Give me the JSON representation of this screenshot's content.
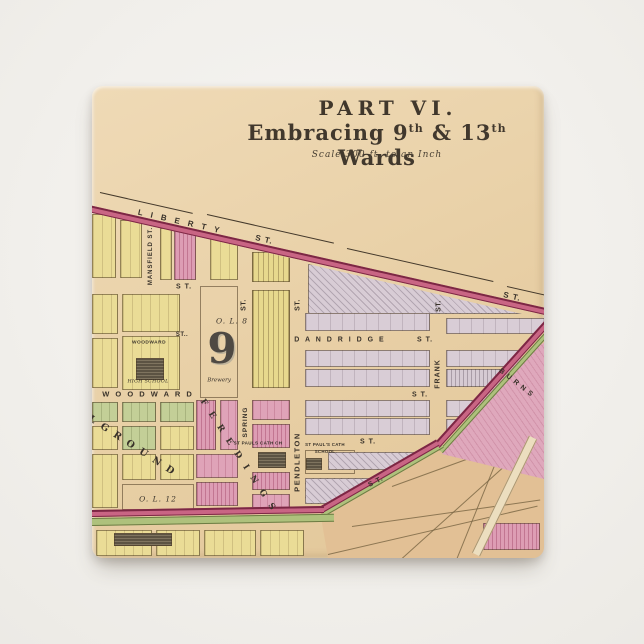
{
  "page": {
    "background_color": "#f1efeb"
  },
  "button": {
    "surface_color": "#e9d1a8",
    "shape": "square-pin"
  },
  "map": {
    "title": "PART VI.",
    "subtitle_parts": {
      "a": "Embracing 9",
      "b": "th",
      "c": " & 13",
      "d": "th",
      "e": " Wards"
    },
    "scale_note": "Scale 300 ft. to an Inch",
    "ward_number": "9",
    "colors": {
      "paper": "#e9d1a8",
      "road_pink": "#c96584",
      "road_border": "#7c2744",
      "green_strip": "#aec17c",
      "block_yellow": "#eadc96",
      "block_lavender": "#d9cdd6",
      "block_pink": "#dfa3b8",
      "block_green": "#c3cf97",
      "area_tan": "#e2c095",
      "ink": "#39322a"
    },
    "labels": [
      {
        "n": "street-label-liberty",
        "t": "L I B E R T Y",
        "x": 88,
        "y": 136,
        "s": 8,
        "r": 12.7,
        "ls": 3,
        "c": "lb-st"
      },
      {
        "n": "street-label-liberty-st",
        "t": "S T.",
        "x": 172,
        "y": 154,
        "s": 8,
        "r": 12.7,
        "ls": 1,
        "c": "lb-st"
      },
      {
        "n": "street-label-liberty-st-2",
        "t": "S T.",
        "x": 420,
        "y": 211,
        "s": 8,
        "r": 12.7,
        "ls": 1,
        "c": "lb-st"
      },
      {
        "n": "street-label-mansfield",
        "t": "MANSFIELD ST.",
        "x": 59,
        "y": 170,
        "s": 6,
        "r": -90,
        "ls": 1,
        "c": "lb-st"
      },
      {
        "n": "street-label-st-left",
        "t": "S T.",
        "x": 92,
        "y": 201,
        "s": 7,
        "r": 0,
        "ls": 1,
        "c": "lb-st"
      },
      {
        "n": "street-label-st-small",
        "t": "ST..",
        "x": 90,
        "y": 249,
        "s": 6,
        "r": 0,
        "ls": 0.5,
        "c": "lb-st"
      },
      {
        "n": "street-label-st-v1",
        "t": "ST.",
        "x": 152,
        "y": 219,
        "s": 7,
        "r": -90,
        "ls": 0.5,
        "c": "lb-st"
      },
      {
        "n": "street-label-st-v2",
        "t": "ST.",
        "x": 206,
        "y": 219,
        "s": 7,
        "r": -90,
        "ls": 0.5,
        "c": "lb-st"
      },
      {
        "n": "outlot-label-8",
        "t": "O. L.  8",
        "x": 140,
        "y": 235,
        "s": 7.5,
        "r": 0,
        "ls": 1,
        "c": "lb-it"
      },
      {
        "n": "ward-number",
        "t": "9",
        "x": 130,
        "y": 263,
        "s": 42,
        "r": 0,
        "ls": 0,
        "c": "lb-ward"
      },
      {
        "n": "place-label-brewery",
        "t": "Brewery",
        "x": 127,
        "y": 295,
        "s": 5.5,
        "r": 0,
        "ls": 0,
        "c": "lb-it"
      },
      {
        "n": "place-label-woodward-school-1",
        "t": "WOODWARD",
        "x": 57,
        "y": 258,
        "s": 4.8,
        "r": 0,
        "ls": 0.5,
        "c": "lb-st"
      },
      {
        "n": "place-label-woodward-school-2",
        "t": "HIGH SCHOOL",
        "x": 56,
        "y": 297,
        "s": 4.8,
        "r": 0,
        "ls": 0.3,
        "c": "lb-it"
      },
      {
        "n": "street-label-woodward",
        "t": "W O O D W A R D",
        "x": 56,
        "y": 308,
        "s": 7.5,
        "r": 0,
        "ls": 2,
        "c": "lb-st"
      },
      {
        "n": "street-label-dandridge",
        "t": "D A N D R I D G E",
        "x": 248,
        "y": 254,
        "s": 7,
        "r": 0,
        "ls": 2,
        "c": "lb-st"
      },
      {
        "n": "street-label-dandridge-st",
        "t": "S T.",
        "x": 333,
        "y": 254,
        "s": 7,
        "r": 0,
        "ls": 1,
        "c": "lb-st"
      },
      {
        "n": "street-label-frank-st-part",
        "t": "ST.",
        "x": 347,
        "y": 220,
        "s": 7,
        "r": -90,
        "ls": 0.5,
        "c": "lb-st"
      },
      {
        "n": "street-label-frank",
        "t": "FRANK",
        "x": 346,
        "y": 288,
        "s": 7,
        "r": -90,
        "ls": 1,
        "c": "lb-st"
      },
      {
        "n": "street-label-st-right",
        "t": "S T.",
        "x": 328,
        "y": 309,
        "s": 7,
        "r": 0,
        "ls": 1,
        "c": "lb-st"
      },
      {
        "n": "street-label-spring",
        "t": "SPRING",
        "x": 154,
        "y": 336,
        "s": 6.5,
        "r": -90,
        "ls": 1,
        "c": "lb-st"
      },
      {
        "n": "street-label-pendleton",
        "t": "PENDLETON",
        "x": 205,
        "y": 376,
        "s": 7.5,
        "r": -90,
        "ls": 1.5,
        "c": "lb-st"
      },
      {
        "n": "place-label-st-pauls-church",
        "t": "ST PAULS CATH CH",
        "x": 166,
        "y": 358,
        "s": 4.6,
        "r": 0,
        "ls": 0.3,
        "c": "lb-st"
      },
      {
        "n": "place-label-st-pauls-school-1",
        "t": "ST PAUL'S CATH",
        "x": 233,
        "y": 359,
        "s": 4.4,
        "r": 0,
        "ls": 0.3,
        "c": "lb-st"
      },
      {
        "n": "place-label-st-pauls-school-2",
        "t": "SCHOOL",
        "x": 233,
        "y": 366,
        "s": 4.4,
        "r": 0,
        "ls": 0.3,
        "c": "lb-st"
      },
      {
        "n": "street-label-st-mid",
        "t": "S T.",
        "x": 276,
        "y": 356,
        "s": 7,
        "r": 0,
        "ls": 1,
        "c": "lb-st"
      },
      {
        "n": "street-label-st-diagonal",
        "t": "S T.",
        "x": 284,
        "y": 396,
        "s": 7,
        "r": -27,
        "ls": 1,
        "c": "lb-st"
      },
      {
        "n": "place-label-fere-dings",
        "t": "F E R E  D I N G S",
        "x": 146,
        "y": 370,
        "s": 8.5,
        "r": 57,
        "ls": 3,
        "c": "lb-ser"
      },
      {
        "n": "place-label-burial-ground",
        "t": "L  G R O U N D",
        "x": 40,
        "y": 360,
        "s": 9.5,
        "r": 33,
        "ls": 2,
        "c": "lb-ser"
      },
      {
        "n": "outlot-label-12",
        "t": "O. L.  12",
        "x": 66,
        "y": 413,
        "s": 7.5,
        "r": 0,
        "ls": 1,
        "c": "lb-it"
      },
      {
        "n": "place-label-burns",
        "t": "B U R N S",
        "x": 424,
        "y": 297,
        "s": 7,
        "r": 38,
        "ls": 1,
        "c": "lb-st"
      }
    ],
    "blocks": [
      [
        0,
        128,
        24,
        64,
        "y"
      ],
      [
        28,
        134,
        22,
        58,
        "y"
      ],
      [
        68,
        142,
        12,
        52,
        "y"
      ],
      [
        82,
        142,
        22,
        52,
        "ph"
      ],
      [
        118,
        150,
        28,
        44,
        "y"
      ],
      [
        160,
        166,
        38,
        30,
        "ys"
      ],
      [
        0,
        208,
        26,
        40,
        "y"
      ],
      [
        30,
        208,
        58,
        38,
        "y"
      ],
      [
        108,
        200,
        38,
        112,
        "open"
      ],
      [
        160,
        204,
        38,
        98,
        "ys"
      ],
      [
        0,
        252,
        26,
        50,
        "y"
      ],
      [
        30,
        250,
        58,
        54,
        "y"
      ],
      [
        44,
        272,
        28,
        22,
        "d"
      ],
      [
        216,
        178,
        214,
        50,
        "lh tri"
      ],
      [
        0,
        316,
        26,
        20,
        "g"
      ],
      [
        30,
        316,
        34,
        20,
        "g"
      ],
      [
        68,
        316,
        34,
        20,
        "g"
      ],
      [
        0,
        340,
        26,
        24,
        "y"
      ],
      [
        30,
        340,
        34,
        24,
        "g"
      ],
      [
        68,
        340,
        34,
        24,
        "y"
      ],
      [
        0,
        368,
        26,
        54,
        "y"
      ],
      [
        30,
        368,
        34,
        26,
        "y"
      ],
      [
        68,
        368,
        34,
        26,
        "y"
      ],
      [
        30,
        398,
        72,
        26,
        "open"
      ],
      [
        104,
        314,
        20,
        50,
        "ph"
      ],
      [
        128,
        314,
        18,
        50,
        "p"
      ],
      [
        104,
        368,
        42,
        24,
        "p"
      ],
      [
        104,
        396,
        42,
        24,
        "ph"
      ],
      [
        160,
        314,
        38,
        20,
        "p"
      ],
      [
        160,
        338,
        38,
        24,
        "ph"
      ],
      [
        166,
        366,
        28,
        16,
        "d"
      ],
      [
        160,
        386,
        38,
        18,
        "ph"
      ],
      [
        160,
        408,
        38,
        16,
        "p"
      ],
      [
        213,
        227,
        125,
        18,
        "l"
      ],
      [
        213,
        264,
        125,
        17,
        "l"
      ],
      [
        213,
        283,
        125,
        18,
        "l"
      ],
      [
        213,
        314,
        125,
        17,
        "l"
      ],
      [
        213,
        332,
        125,
        17,
        "l"
      ],
      [
        213,
        364,
        50,
        24,
        "open"
      ],
      [
        214,
        372,
        16,
        12,
        "d"
      ],
      [
        236,
        366,
        100,
        18,
        "lh"
      ],
      [
        213,
        392,
        125,
        26,
        "lh"
      ],
      [
        354,
        232,
        100,
        16,
        "l"
      ],
      [
        354,
        264,
        100,
        17,
        "l"
      ],
      [
        354,
        283,
        100,
        18,
        "ls"
      ],
      [
        354,
        314,
        100,
        17,
        "l"
      ],
      [
        354,
        333,
        100,
        16,
        "l"
      ],
      [
        4,
        444,
        56,
        26,
        "y"
      ],
      [
        64,
        444,
        44,
        26,
        "y"
      ],
      [
        112,
        444,
        52,
        26,
        "y"
      ],
      [
        168,
        444,
        44,
        26,
        "y"
      ],
      [
        22,
        447,
        58,
        13,
        "d"
      ]
    ],
    "tan_blocks": [
      [
        391,
        437,
        57,
        27,
        "ph"
      ]
    ],
    "tan_lines": [
      [
        236,
        468,
        215,
        -13
      ],
      [
        260,
        440,
        190,
        -8
      ],
      [
        310,
        472,
        160,
        -42
      ],
      [
        365,
        472,
        120,
        -68
      ],
      [
        300,
        400,
        140,
        -20
      ]
    ],
    "roads": [
      [
        349,
        363,
        172,
        5,
        -48,
        "green"
      ],
      [
        231,
        426,
        138,
        5,
        -30,
        "green"
      ],
      [
        0,
        432,
        242,
        8,
        -1,
        "green"
      ],
      [
        -8,
        118,
        478,
        7,
        12.7,
        "main"
      ],
      [
        345,
        356,
        172,
        7,
        -48,
        "main"
      ],
      [
        228,
        421,
        136,
        7,
        -30,
        "main"
      ],
      [
        0,
        424,
        232,
        7,
        -1,
        "main"
      ],
      [
        384,
        464,
        130,
        9,
        -64,
        "pale"
      ],
      [
        8,
        106,
        95,
        0,
        12.7,
        "survey"
      ],
      [
        115,
        128,
        130,
        0,
        12.7,
        "survey"
      ],
      [
        255,
        162,
        150,
        0,
        12.7,
        "survey"
      ],
      [
        415,
        200,
        55,
        0,
        12.7,
        "survey"
      ]
    ]
  }
}
